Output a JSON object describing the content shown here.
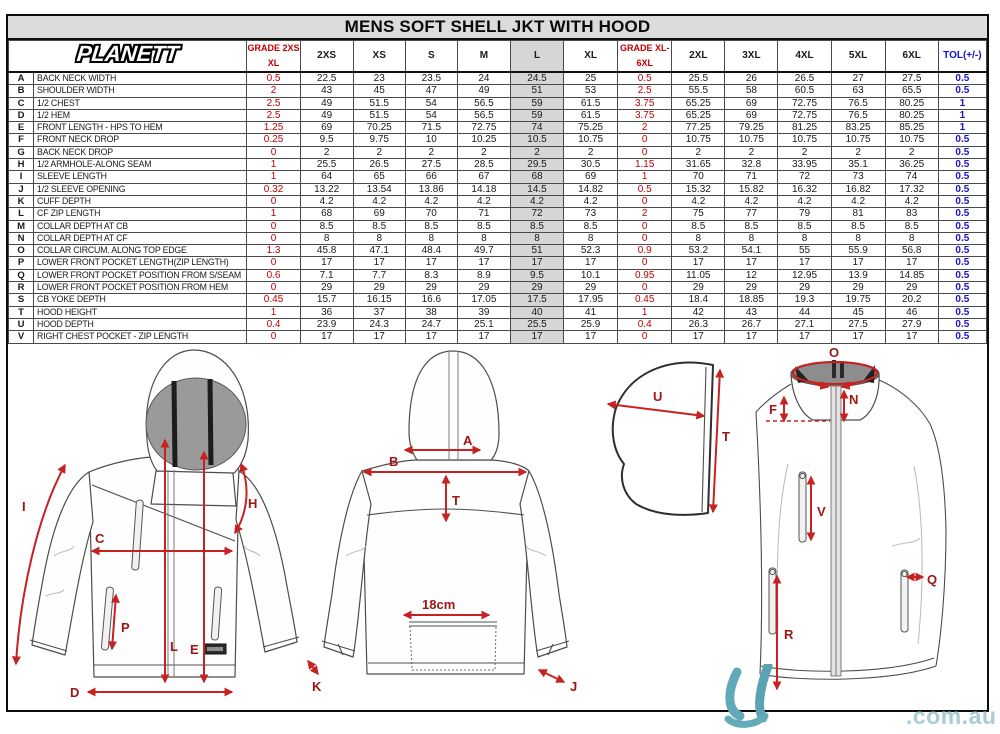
{
  "title": "MENS SOFT SHELL JKT WITH HOOD",
  "brand": "PLANETT",
  "table": {
    "grade1_line1": "GRADE 2XS-",
    "grade1_line2": "XL",
    "grade2_line1": "GRADE  XL-",
    "grade2_line2": "6XL",
    "size_headers_left": [
      "2XS",
      "XS",
      "S",
      "M",
      "L",
      "XL"
    ],
    "size_headers_right": [
      "2XL",
      "3XL",
      "4XL",
      "5XL",
      "6XL"
    ],
    "tol_header": "TOL(+/-)",
    "rows": [
      [
        "A",
        "BACK NECK WIDTH",
        "0.5",
        "22.5",
        "23",
        "23.5",
        "24",
        "24.5",
        "25",
        "0.5",
        "25.5",
        "26",
        "26.5",
        "27",
        "27.5",
        "0.5"
      ],
      [
        "B",
        "SHOULDER WIDTH",
        "2",
        "43",
        "45",
        "47",
        "49",
        "51",
        "53",
        "2.5",
        "55.5",
        "58",
        "60.5",
        "63",
        "65.5",
        "0.5"
      ],
      [
        "C",
        "1/2 CHEST",
        "2.5",
        "49",
        "51.5",
        "54",
        "56.5",
        "59",
        "61.5",
        "3.75",
        "65.25",
        "69",
        "72.75",
        "76.5",
        "80.25",
        "1"
      ],
      [
        "D",
        "1/2 HEM",
        "2.5",
        "49",
        "51.5",
        "54",
        "56.5",
        "59",
        "61.5",
        "3.75",
        "65.25",
        "69",
        "72.75",
        "76.5",
        "80.25",
        "1"
      ],
      [
        "E",
        "FRONT LENGTH - HPS TO HEM",
        "1.25",
        "69",
        "70.25",
        "71.5",
        "72.75",
        "74",
        "75.25",
        "2",
        "77.25",
        "79.25",
        "81.25",
        "83.25",
        "85.25",
        "1"
      ],
      [
        "F",
        "FRONT NECK DROP",
        "0.25",
        "9.5",
        "9.75",
        "10",
        "10.25",
        "10.5",
        "10.75",
        "0",
        "10.75",
        "10.75",
        "10.75",
        "10.75",
        "10.75",
        "0.5"
      ],
      [
        "G",
        "BACK NECK DROP",
        "0",
        "2",
        "2",
        "2",
        "2",
        "2",
        "2",
        "0",
        "2",
        "2",
        "2",
        "2",
        "2",
        "0.5"
      ],
      [
        "H",
        "1/2 ARMHOLE-ALONG SEAM",
        "1",
        "25.5",
        "26.5",
        "27.5",
        "28.5",
        "29.5",
        "30.5",
        "1.15",
        "31.65",
        "32.8",
        "33.95",
        "35.1",
        "36.25",
        "0.5"
      ],
      [
        "I",
        "SLEEVE LENGTH",
        "1",
        "64",
        "65",
        "66",
        "67",
        "68",
        "69",
        "1",
        "70",
        "71",
        "72",
        "73",
        "74",
        "0.5"
      ],
      [
        "J",
        "1/2 SLEEVE OPENING",
        "0.32",
        "13.22",
        "13.54",
        "13.86",
        "14.18",
        "14.5",
        "14.82",
        "0.5",
        "15.32",
        "15.82",
        "16.32",
        "16.82",
        "17.32",
        "0.5"
      ],
      [
        "K",
        "CUFF DEPTH",
        "0",
        "4.2",
        "4.2",
        "4.2",
        "4.2",
        "4.2",
        "4.2",
        "0",
        "4.2",
        "4.2",
        "4.2",
        "4.2",
        "4.2",
        "0.5"
      ],
      [
        "L",
        "CF ZIP LENGTH",
        "1",
        "68",
        "69",
        "70",
        "71",
        "72",
        "73",
        "2",
        "75",
        "77",
        "79",
        "81",
        "83",
        "0.5"
      ],
      [
        "M",
        "COLLAR DEPTH AT CB",
        "0",
        "8.5",
        "8.5",
        "8.5",
        "8.5",
        "8.5",
        "8.5",
        "0",
        "8.5",
        "8.5",
        "8.5",
        "8.5",
        "8.5",
        "0.5"
      ],
      [
        "N",
        "COLLAR DEPTH AT CF",
        "0",
        "8",
        "8",
        "8",
        "8",
        "8",
        "8",
        "0",
        "8",
        "8",
        "8",
        "8",
        "8",
        "0.5"
      ],
      [
        "O",
        "COLLAR CIRCUM. ALONG TOP EDGE",
        "1.3",
        "45.8",
        "47.1",
        "48.4",
        "49.7",
        "51",
        "52.3",
        "0.9",
        "53.2",
        "54.1",
        "55",
        "55.9",
        "56.8",
        "0.5"
      ],
      [
        "P",
        "LOWER FRONT POCKET LENGTH(ZIP LENGTH)",
        "0",
        "17",
        "17",
        "17",
        "17",
        "17",
        "17",
        "0",
        "17",
        "17",
        "17",
        "17",
        "17",
        "0.5"
      ],
      [
        "Q",
        "LOWER FRONT POCKET POSITION FROM S/SEAM",
        "0.6",
        "7.1",
        "7.7",
        "8.3",
        "8.9",
        "9.5",
        "10.1",
        "0.95",
        "11.05",
        "12",
        "12.95",
        "13.9",
        "14.85",
        "0.5"
      ],
      [
        "R",
        "LOWER FRONT POCKET POSITION FROM HEM",
        "0",
        "29",
        "29",
        "29",
        "29",
        "29",
        "29",
        "0",
        "29",
        "29",
        "29",
        "29",
        "29",
        "0.5"
      ],
      [
        "S",
        "CB YOKE DEPTH",
        "0.45",
        "15.7",
        "16.15",
        "16.6",
        "17.05",
        "17.5",
        "17.95",
        "0.45",
        "18.4",
        "18.85",
        "19.3",
        "19.75",
        "20.2",
        "0.5"
      ],
      [
        "T",
        "HOOD HEIGHT",
        "1",
        "36",
        "37",
        "38",
        "39",
        "40",
        "41",
        "1",
        "42",
        "43",
        "44",
        "45",
        "46",
        "0.5"
      ],
      [
        "U",
        "HOOD DEPTH",
        "0.4",
        "23.9",
        "24.3",
        "24.7",
        "25.1",
        "25.5",
        "25.9",
        "0.4",
        "26.3",
        "26.7",
        "27.1",
        "27.5",
        "27.9",
        "0.5"
      ],
      [
        "V",
        "RIGHT CHEST POCKET - ZIP LENGTH",
        "0",
        "17",
        "17",
        "17",
        "17",
        "17",
        "17",
        "0",
        "17",
        "17",
        "17",
        "17",
        "17",
        "0.5"
      ]
    ]
  },
  "diagram": {
    "front": {
      "I": "I",
      "C": "C",
      "H": "H",
      "L": "L",
      "E": "E",
      "P": "P",
      "D": "D",
      "K": "K"
    },
    "back": {
      "A": "A",
      "B": "B",
      "T": "T",
      "J": "J",
      "pocket_width": "18cm"
    },
    "hood": {
      "U": "U",
      "T": "T"
    },
    "collar": {
      "O": "O",
      "N": "N",
      "F": "F",
      "V": "V",
      "R": "R",
      "Q": "Q"
    },
    "watermark": ".com.au"
  },
  "colors": {
    "grade_red": "#c00000",
    "tol_blue": "#1414cc",
    "size_l_shade": "#d6d6d6",
    "arrow_red": "#c62222",
    "watermark_teal": "#61a9b8"
  }
}
